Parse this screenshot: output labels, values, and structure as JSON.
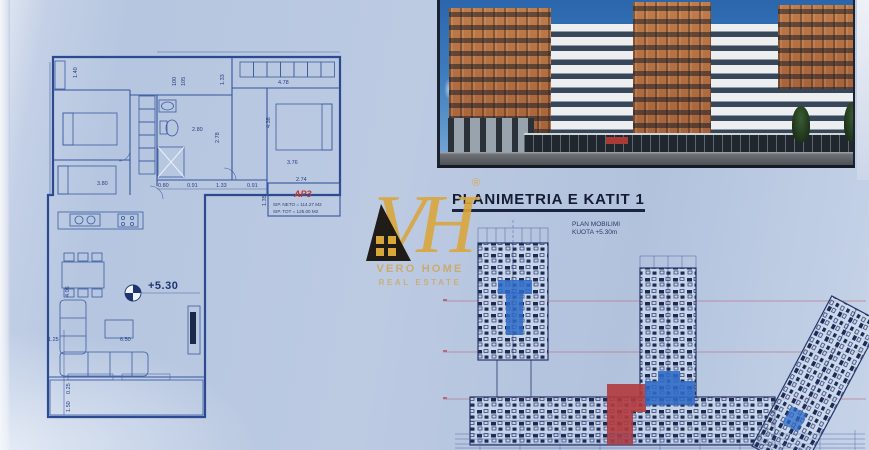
{
  "colors": {
    "paper": "#b9c9e2",
    "plan_line": "#2b4a8f",
    "highlight_blue": "#2e6bc8",
    "highlight_red": "#b23b3e",
    "logo_gold": "#d9a63c",
    "title_text": "#141c33"
  },
  "logo": {
    "initials": "VH",
    "registered_mark": "®",
    "line1": "VERO HOME",
    "line2": "REAL ESTATE"
  },
  "floorplan": {
    "apartment_label": "AP3",
    "area_neto": "SIP. NETO = 114.27 M2",
    "area_total": "SIP. TOT = 125.00 M2",
    "level_label": "+5.30",
    "dims": [
      "1.40",
      "100",
      "105",
      "1.33",
      "4.78",
      "2.80",
      "2.78",
      "4.38",
      "3.76",
      "3.80",
      "0.80",
      "0.91",
      "1.33",
      "0.91",
      "2.74",
      "1.35",
      "4.05",
      "1.25",
      "6.50",
      "0.25",
      "1.50"
    ]
  },
  "siteplan": {
    "title": "PLANIMETRIA E KATIT 1",
    "note_line1": "PLAN MOBILIMI",
    "note_line2": "KUOTA +5.30m"
  }
}
